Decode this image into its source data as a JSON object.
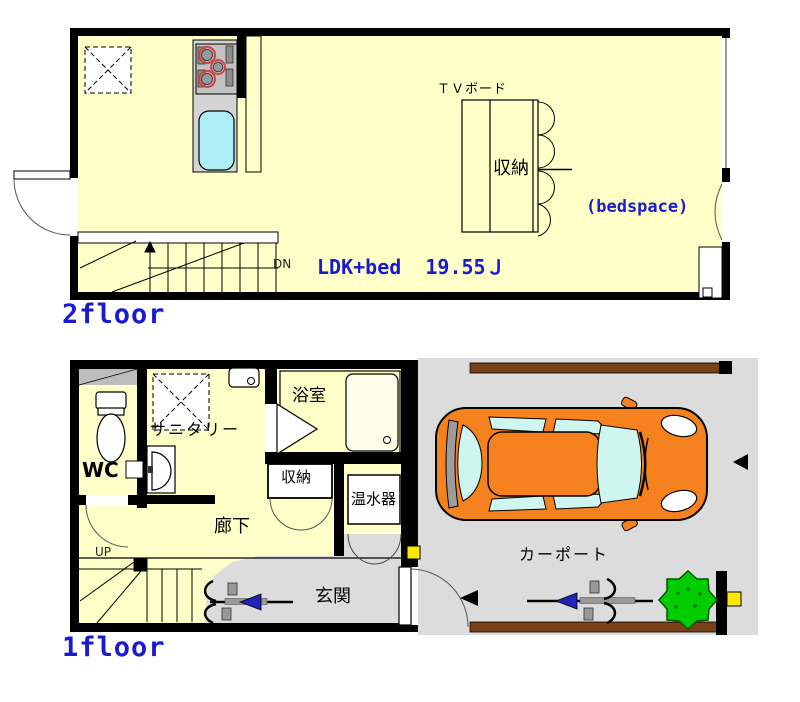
{
  "colors": {
    "floor_fill": "#FFFFC8",
    "wall": "#000000",
    "text_blue": "#1A1ACF",
    "carport_gray": "#DCDCDC",
    "car_body": "#F6821F",
    "glass_cyan": "#CFF5F0",
    "bush_green": "#00CC00",
    "fence_brown": "#7A4017",
    "marker_yellow": "#FFE800",
    "sink_cyan": "#AEEFF5"
  },
  "floor2": {
    "label": "2floor",
    "room_label": "LDK+bed  19.55Ｊ",
    "tv_board": "ＴＶボード",
    "closet": "収納",
    "bedspace": "(bedspace)",
    "stair": "DN"
  },
  "floor1": {
    "label": "1floor",
    "wc": "WC",
    "sanitary": "サニタリー",
    "bath": "浴室",
    "closet": "収納",
    "water_heater": "温水器",
    "hallway": "廊下",
    "stair": "UP",
    "entrance": "玄関"
  },
  "carport": {
    "label": "カーポート"
  }
}
